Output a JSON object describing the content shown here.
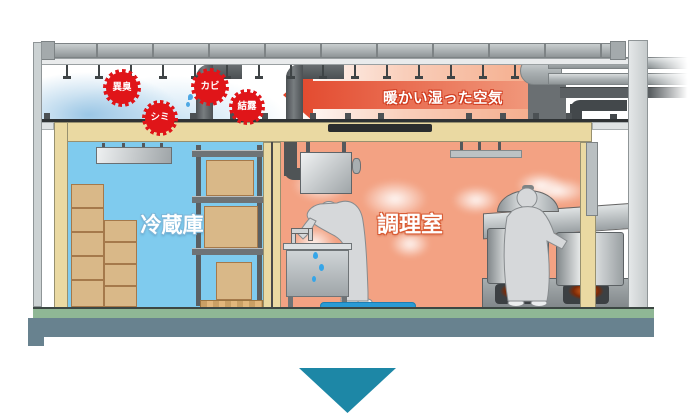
{
  "diagram": {
    "warm_air_label": "暖かい湿った空気",
    "rooms": [
      {
        "id": "cold-storage",
        "label": "冷蔵庫"
      },
      {
        "id": "kitchen",
        "label": "調理室"
      }
    ],
    "problem_badges": [
      {
        "id": "odor",
        "label": "異臭"
      },
      {
        "id": "mold",
        "label": "カビ"
      },
      {
        "id": "condensation",
        "label": "結露"
      },
      {
        "id": "stain",
        "label": "シミ"
      }
    ]
  },
  "icons": {
    "warm_air_arrow": "left-arrow",
    "continue_indicator": "down-triangle",
    "condensation_drip": "water-drop"
  },
  "colors": {
    "badge-red": "#e01519",
    "arrow-red": "#e2452a",
    "arrow-red-light": "#f2a184",
    "cold-room": "#7fcbee",
    "hot-room": "#f3a283",
    "wall-beige": "#ead9a2",
    "floor-green": "#8fb795",
    "foundation-gray": "#68828f",
    "teal-arrow": "#1d87a6",
    "box-tan": "#d9b888",
    "steel-dark": "#55595c",
    "steel-light": "#c3c8c9"
  }
}
